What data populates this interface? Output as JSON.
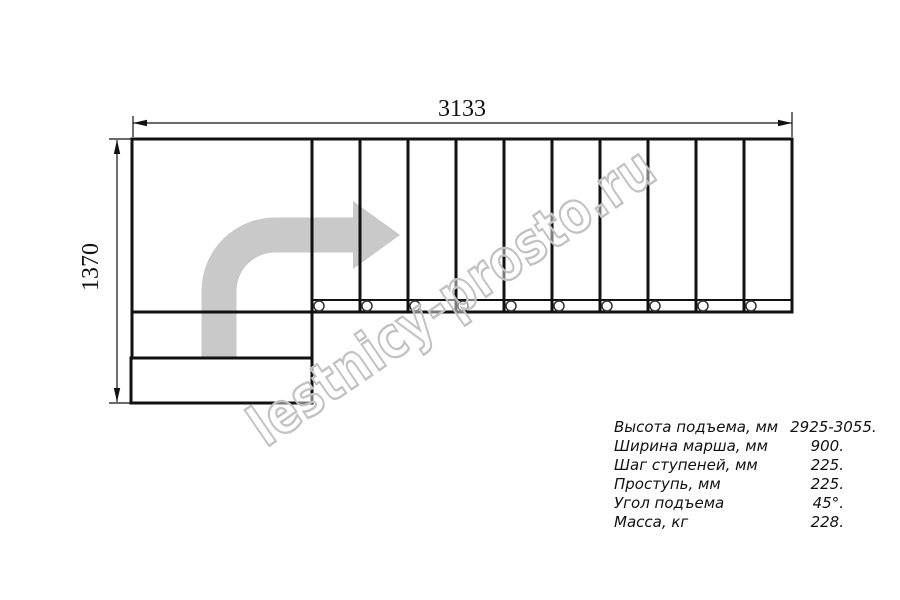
{
  "drawing": {
    "width_label": "3133",
    "height_label": "1370",
    "watermark": "lestnicy-prosto.ru",
    "colors": {
      "line": "#111111",
      "arrow": "#c9c9c9",
      "watermark": "#c2c2c2"
    }
  },
  "specs": {
    "rows": [
      {
        "label": "Высота подъема, мм",
        "value": "2925-3055."
      },
      {
        "label": "Ширина марша, мм",
        "value": "900."
      },
      {
        "label": "Шаг ступеней, мм",
        "value": "225."
      },
      {
        "label": "Проступь, мм",
        "value": "225."
      },
      {
        "label": "Угол подъема",
        "value": "45°."
      },
      {
        "label": "Масса, кг",
        "value": "228."
      }
    ]
  }
}
